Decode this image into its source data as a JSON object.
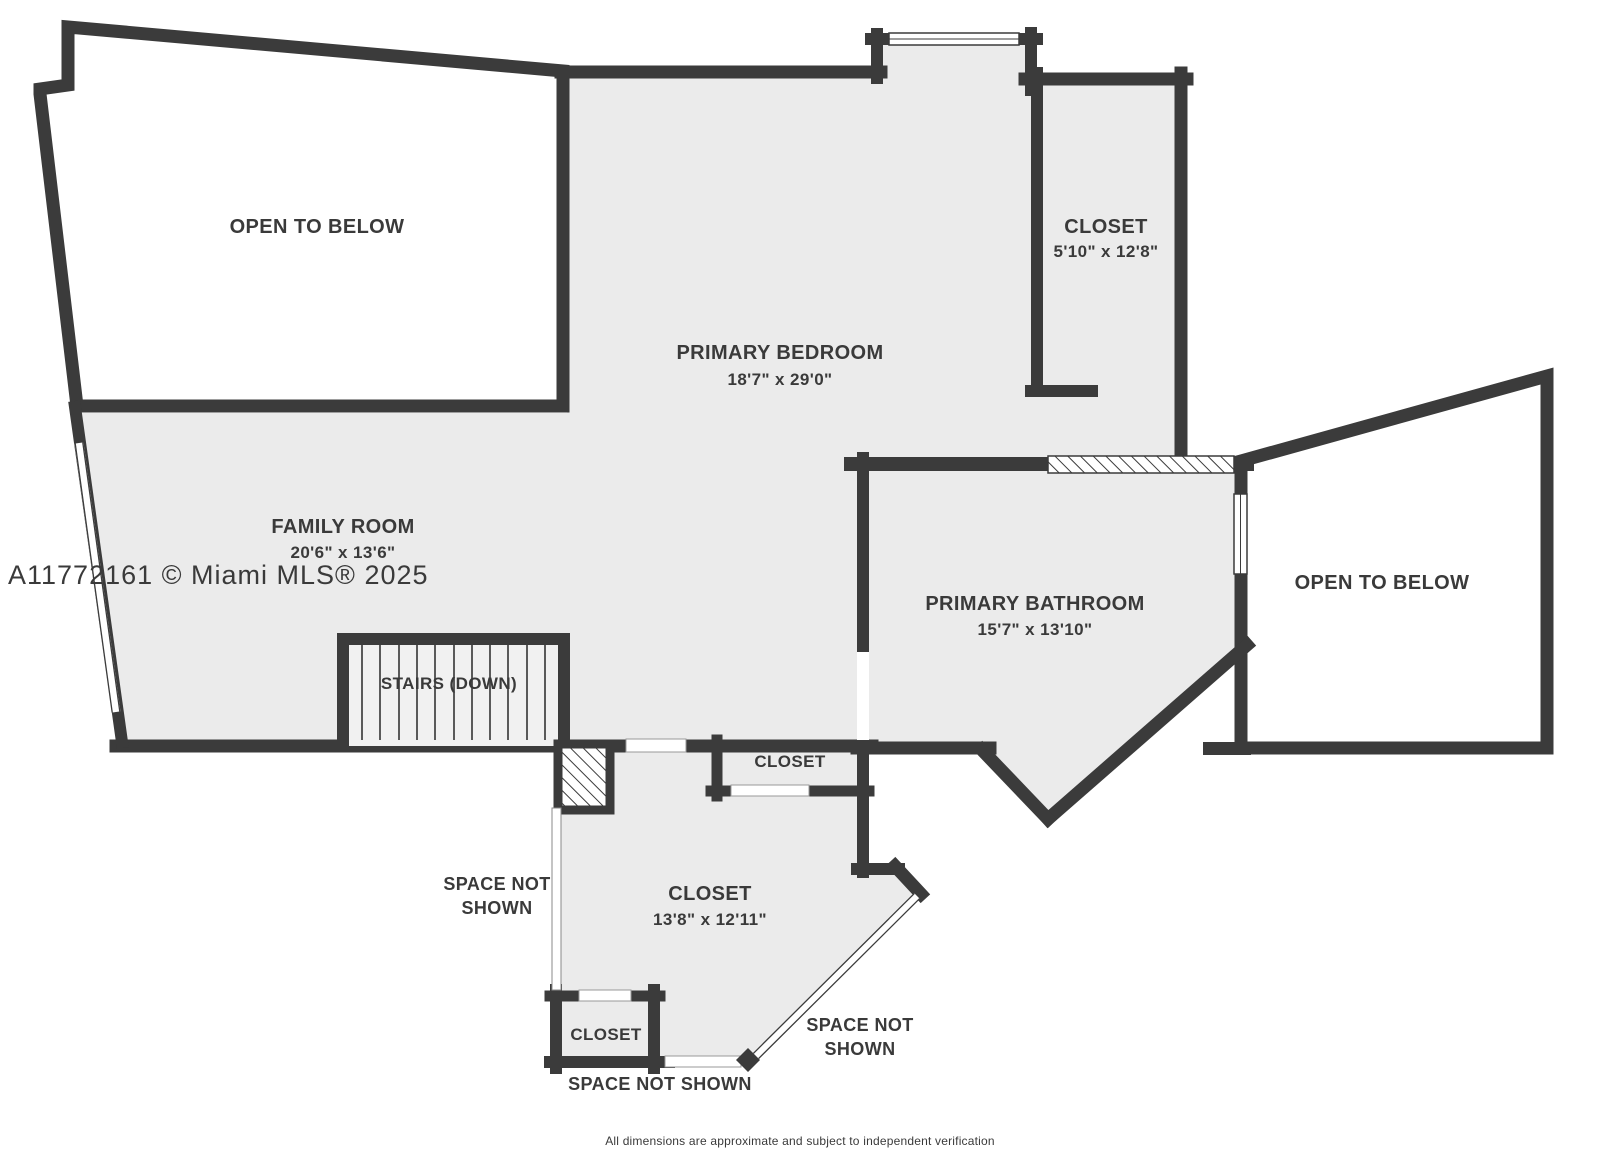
{
  "plan": {
    "rooms": {
      "open_below_tl": {
        "label": "OPEN TO BELOW"
      },
      "primary_bedroom": {
        "label": "PRIMARY BEDROOM",
        "dims": "18'7\" x 29'0\""
      },
      "closet_top_right": {
        "label": "CLOSET",
        "dims": "5'10\" x 12'8\""
      },
      "family_room": {
        "label": "FAMILY ROOM",
        "dims": "20'6\" x 13'6\""
      },
      "primary_bathroom": {
        "label": "PRIMARY BATHROOM",
        "dims": "15'7\" x 13'10\""
      },
      "open_below_right": {
        "label": "OPEN TO BELOW"
      },
      "stairs": {
        "label": "STAIRS (DOWN)"
      },
      "closet_hall": {
        "label": "CLOSET"
      },
      "closet_large": {
        "label": "CLOSET",
        "dims": "13'8\" x 12'11\""
      },
      "closet_bottom": {
        "label": "CLOSET"
      }
    },
    "annotations": {
      "space_left_line1": "SPACE NOT",
      "space_left_line2": "SHOWN",
      "space_bottom": "SPACE NOT SHOWN",
      "space_right_line1": "SPACE NOT",
      "space_right_line2": "SHOWN"
    },
    "watermark": "A11772161 © Miami MLS® 2025",
    "disclaimer": "All dimensions are approximate and subject to independent verification",
    "colors": {
      "wall": "#3b3b3b",
      "room_fill": "#ebebeb",
      "stairs_fill": "#f1f1f1",
      "open_below_fill": "#ffffff",
      "label_text": "#3a3a3a",
      "watermark_text": "#b7b7b7",
      "disclaimer_text": "#8a8a8a"
    }
  }
}
